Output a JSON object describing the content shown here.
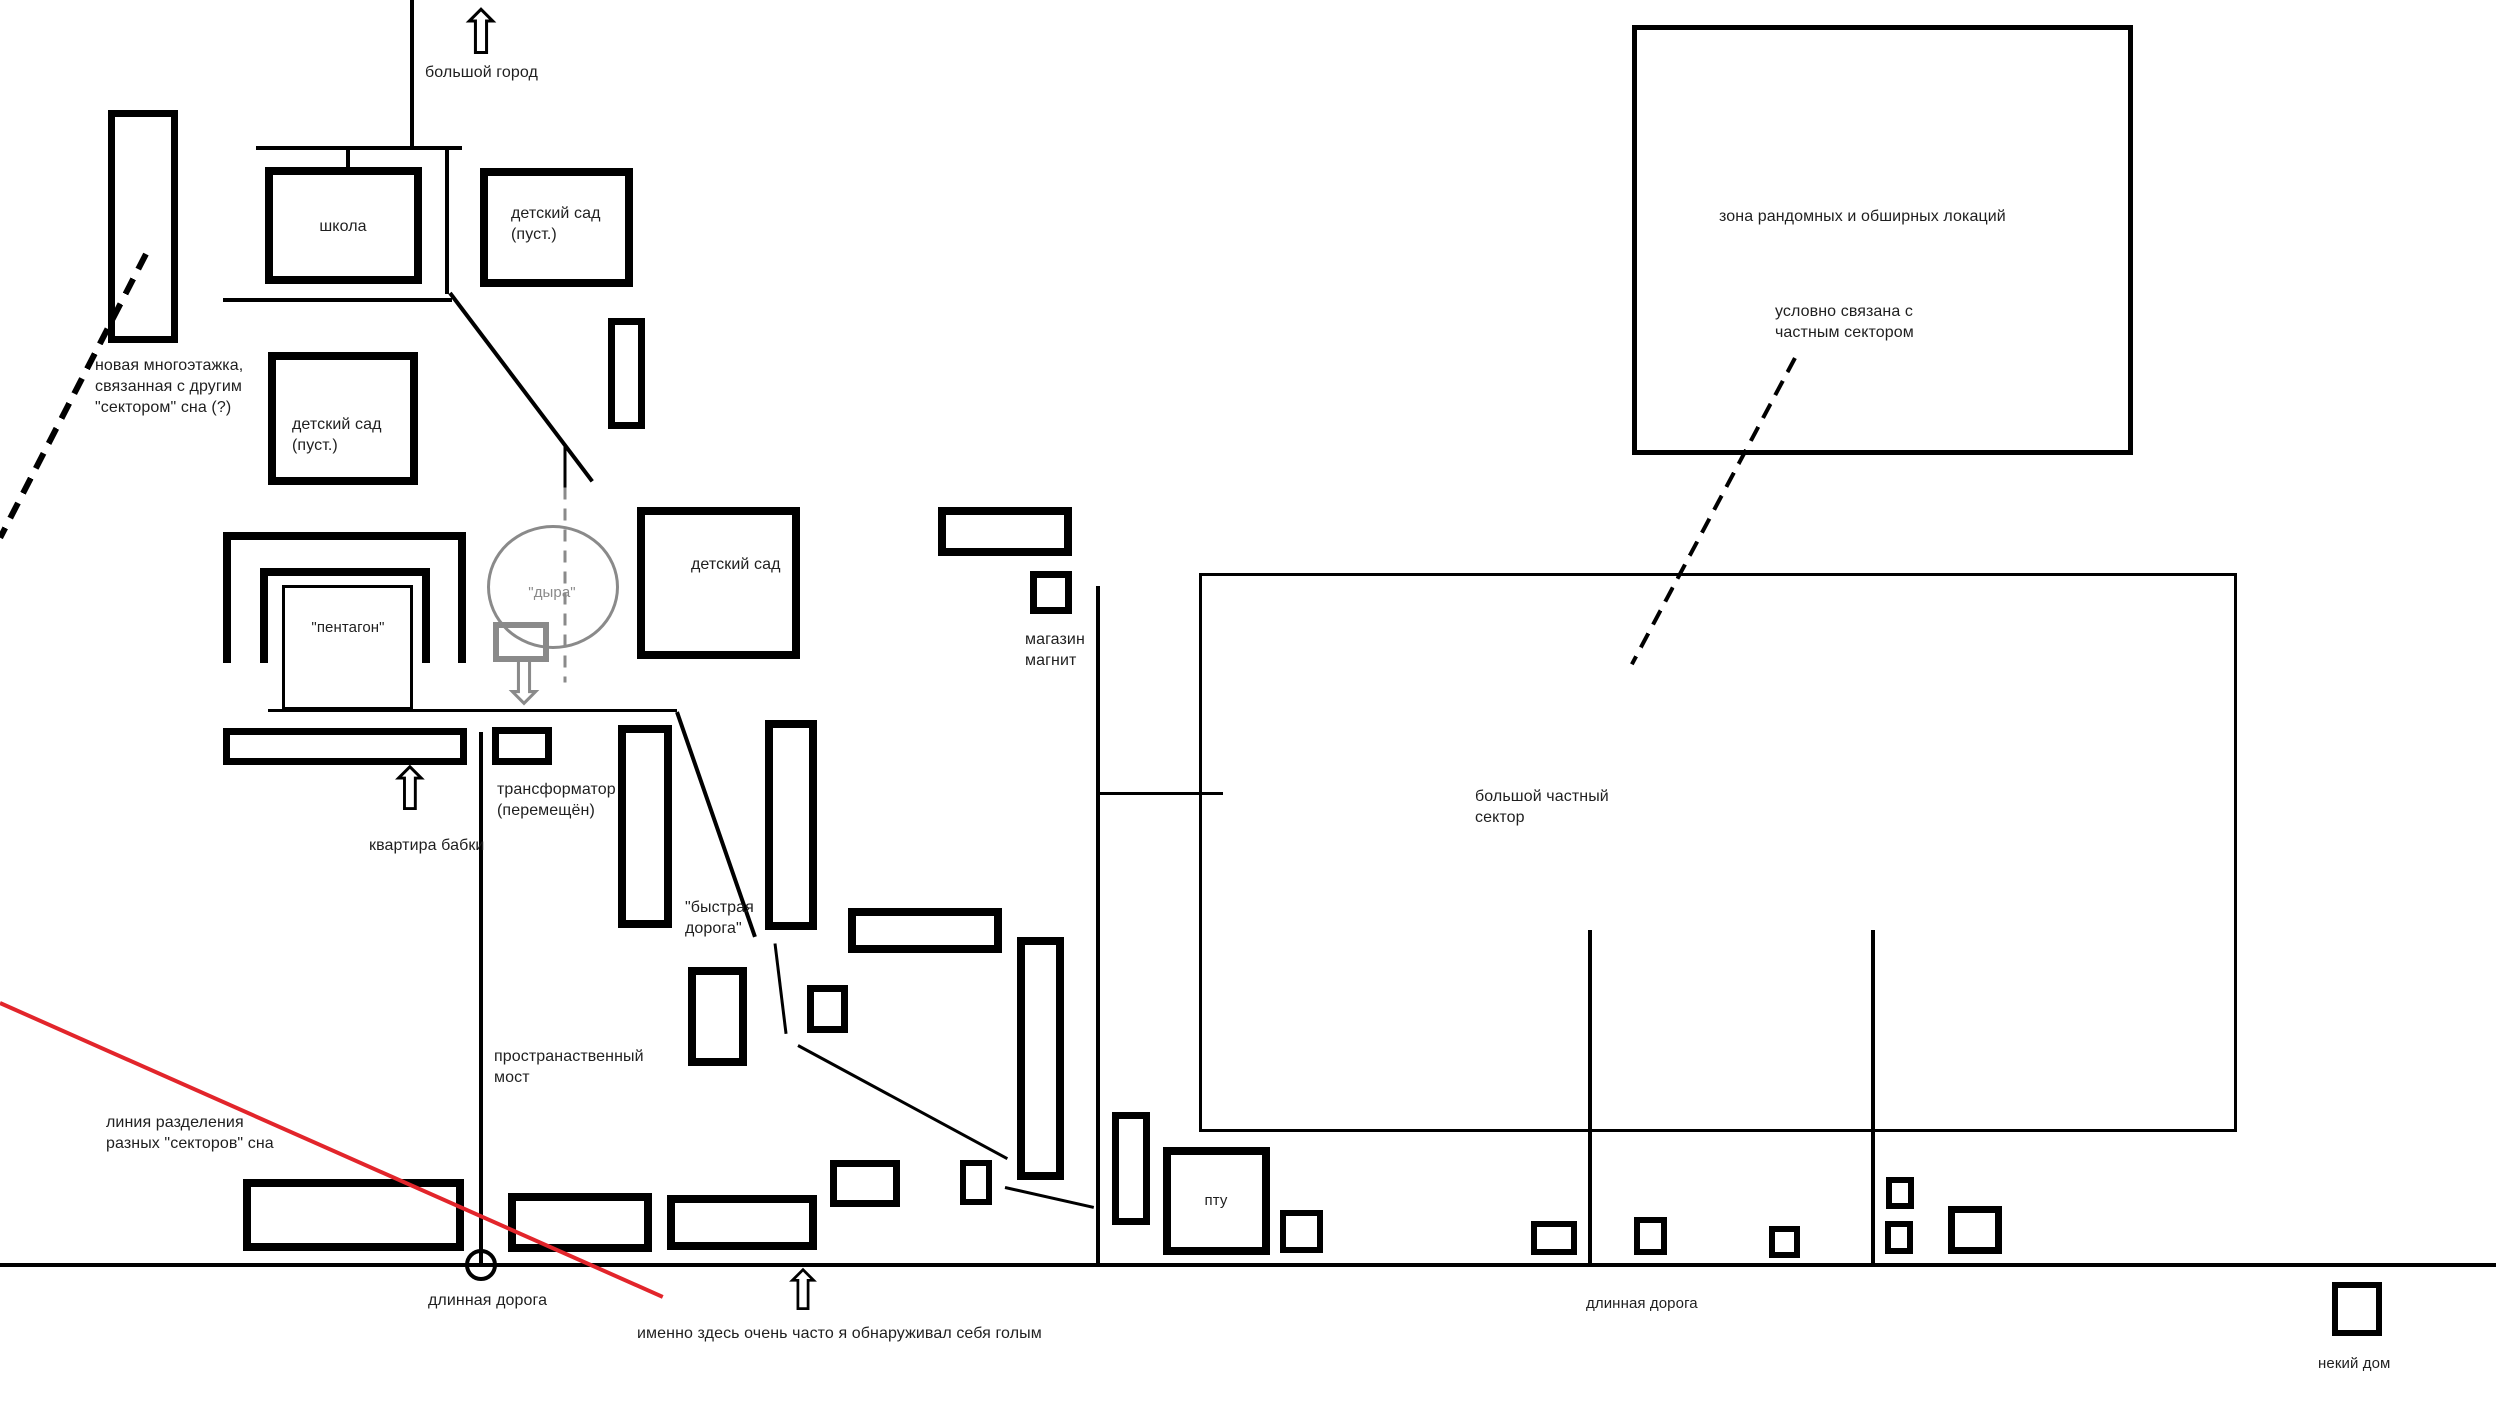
{
  "canvas": {
    "width": 2496,
    "height": 1428,
    "background": "#ffffff"
  },
  "palette": {
    "ink": "#000000",
    "gray": "#8a8a8a",
    "red": "#e2252b",
    "text": "#1f1f1f"
  },
  "labels": [
    {
      "name": "label-big-city",
      "text": "большой город",
      "x": 425,
      "y": 62,
      "size": 16
    },
    {
      "name": "label-new-highrise",
      "text": "новая многоэтажка,\nсвязанная с другим\n\"сектором\" сна (?)",
      "x": 95,
      "y": 355,
      "size": 16
    },
    {
      "name": "label-school",
      "text": "школа",
      "x": 343,
      "y": 216,
      "size": 16,
      "center": true
    },
    {
      "name": "label-kindergarten-1",
      "text": "детский сад\n(пуст.)",
      "x": 511,
      "y": 203,
      "size": 16
    },
    {
      "name": "label-kindergarten-2",
      "text": "детский сад\n(пуст.)",
      "x": 292,
      "y": 414,
      "size": 16
    },
    {
      "name": "label-kindergarten-3",
      "text": "детский сад",
      "x": 691,
      "y": 554,
      "size": 16
    },
    {
      "name": "label-pentagon",
      "text": "\"пентагон\"",
      "x": 348,
      "y": 618,
      "size": 15,
      "center": true
    },
    {
      "name": "label-hole",
      "text": "\"дыра\"",
      "x": 552,
      "y": 583,
      "size": 15,
      "center": true,
      "color": "#8a8a8a"
    },
    {
      "name": "label-magnit-store",
      "text": "магазин\nмагнит",
      "x": 1025,
      "y": 629,
      "size": 16
    },
    {
      "name": "label-random-zone",
      "text": "зона рандомных и обширных локаций",
      "x": 1719,
      "y": 206,
      "size": 16
    },
    {
      "name": "label-linked-note",
      "text": "условно связана с\nчастным сектором",
      "x": 1775,
      "y": 301,
      "size": 16
    },
    {
      "name": "label-private-sector",
      "text": "большой частный\nсектор",
      "x": 1475,
      "y": 786,
      "size": 16
    },
    {
      "name": "label-transformer",
      "text": "трансформатор\n(перемещён)",
      "x": 497,
      "y": 779,
      "size": 16
    },
    {
      "name": "label-grandma-flat",
      "text": "квартира бабки",
      "x": 369,
      "y": 835,
      "size": 16
    },
    {
      "name": "label-fast-road",
      "text": "\"быстрая\nдорога\"",
      "x": 685,
      "y": 897,
      "size": 16
    },
    {
      "name": "label-space-bridge",
      "text": "пространаственный\nмост",
      "x": 494,
      "y": 1046,
      "size": 16
    },
    {
      "name": "label-divide-line",
      "text": "линия разделения\nразных \"секторов\" сна",
      "x": 106,
      "y": 1112,
      "size": 16
    },
    {
      "name": "label-long-road-1",
      "text": "длинная дорога",
      "x": 428,
      "y": 1290,
      "size": 16
    },
    {
      "name": "label-naked-note",
      "text": "именно здесь очень часто я обнаруживал себя голым",
      "x": 637,
      "y": 1323,
      "size": 16
    },
    {
      "name": "label-long-road-2",
      "text": "длинная дорога",
      "x": 1586,
      "y": 1294,
      "size": 15
    },
    {
      "name": "label-some-house",
      "text": "некий дом",
      "x": 2318,
      "y": 1354,
      "size": 15
    },
    {
      "name": "label-ptu",
      "text": "пту",
      "x": 1216,
      "y": 1191,
      "size": 15,
      "center": true
    }
  ],
  "rects": [
    {
      "name": "building-tall-left",
      "x": 108,
      "y": 110,
      "w": 70,
      "h": 233,
      "stroke": 7
    },
    {
      "name": "building-school",
      "x": 265,
      "y": 167,
      "w": 157,
      "h": 117,
      "stroke": 8
    },
    {
      "name": "building-kindergarten-1",
      "x": 480,
      "y": 168,
      "w": 153,
      "h": 119,
      "stroke": 8
    },
    {
      "name": "building-kindergarten-2",
      "x": 268,
      "y": 352,
      "w": 150,
      "h": 133,
      "stroke": 8
    },
    {
      "name": "building-small-vertical-1",
      "x": 608,
      "y": 318,
      "w": 37,
      "h": 111,
      "stroke": 7
    },
    {
      "name": "building-kindergarten-3",
      "x": 637,
      "y": 507,
      "w": 163,
      "h": 152,
      "stroke": 8
    },
    {
      "name": "pentagon-outer-u",
      "x": 223,
      "y": 532,
      "w": 243,
      "h": 131,
      "stroke": 8,
      "open_bottom": true
    },
    {
      "name": "pentagon-inner-u",
      "x": 260,
      "y": 568,
      "w": 170,
      "h": 95,
      "stroke": 8,
      "open_bottom": true
    },
    {
      "name": "pentagon-core",
      "x": 282,
      "y": 585,
      "w": 131,
      "h": 125,
      "stroke": 3
    },
    {
      "name": "building-magnit-wide",
      "x": 938,
      "y": 507,
      "w": 134,
      "h": 49,
      "stroke": 8
    },
    {
      "name": "building-magnit-square",
      "x": 1030,
      "y": 571,
      "w": 42,
      "h": 43,
      "stroke": 7
    },
    {
      "name": "zone-random-locations",
      "x": 1632,
      "y": 25,
      "w": 501,
      "h": 430,
      "stroke": 5
    },
    {
      "name": "zone-private-sector",
      "x": 1199,
      "y": 573,
      "w": 1038,
      "h": 559,
      "stroke": 3
    },
    {
      "name": "building-grandma-bar",
      "x": 223,
      "y": 728,
      "w": 244,
      "h": 37,
      "stroke": 7
    },
    {
      "name": "building-transformer",
      "x": 492,
      "y": 727,
      "w": 60,
      "h": 38,
      "stroke": 7
    },
    {
      "name": "building-tall-mid-1",
      "x": 618,
      "y": 725,
      "w": 54,
      "h": 203,
      "stroke": 8
    },
    {
      "name": "building-tall-mid-2",
      "x": 765,
      "y": 720,
      "w": 52,
      "h": 210,
      "stroke": 8
    },
    {
      "name": "building-mid-bar",
      "x": 848,
      "y": 908,
      "w": 154,
      "h": 45,
      "stroke": 8
    },
    {
      "name": "building-small-square-mid",
      "x": 807,
      "y": 985,
      "w": 41,
      "h": 48,
      "stroke": 7
    },
    {
      "name": "building-vrect-below",
      "x": 688,
      "y": 967,
      "w": 59,
      "h": 99,
      "stroke": 8
    },
    {
      "name": "building-tall-mid-3",
      "x": 1017,
      "y": 937,
      "w": 47,
      "h": 243,
      "stroke": 8
    },
    {
      "name": "building-small-left-ptu",
      "x": 960,
      "y": 1160,
      "w": 32,
      "h": 45,
      "stroke": 6
    },
    {
      "name": "building-vrect-ptu",
      "x": 1112,
      "y": 1112,
      "w": 38,
      "h": 113,
      "stroke": 7
    },
    {
      "name": "building-ptu",
      "x": 1163,
      "y": 1147,
      "w": 107,
      "h": 108,
      "stroke": 8
    },
    {
      "name": "building-square-right-ptu",
      "x": 1280,
      "y": 1210,
      "w": 43,
      "h": 43,
      "stroke": 6
    },
    {
      "name": "building-bottom-row-1",
      "x": 243,
      "y": 1179,
      "w": 221,
      "h": 72,
      "stroke": 8
    },
    {
      "name": "building-bottom-row-2",
      "x": 508,
      "y": 1193,
      "w": 144,
      "h": 59,
      "stroke": 8
    },
    {
      "name": "building-bottom-row-3",
      "x": 667,
      "y": 1195,
      "w": 150,
      "h": 55,
      "stroke": 8
    },
    {
      "name": "building-bottom-row-4",
      "x": 830,
      "y": 1160,
      "w": 70,
      "h": 47,
      "stroke": 7
    },
    {
      "name": "building-sector-sq-1",
      "x": 1531,
      "y": 1221,
      "w": 46,
      "h": 34,
      "stroke": 6
    },
    {
      "name": "building-sector-sq-2",
      "x": 1634,
      "y": 1217,
      "w": 33,
      "h": 38,
      "stroke": 6
    },
    {
      "name": "building-sector-sq-3",
      "x": 1769,
      "y": 1226,
      "w": 31,
      "h": 32,
      "stroke": 6
    },
    {
      "name": "building-sector-sq-4",
      "x": 1886,
      "y": 1177,
      "w": 28,
      "h": 32,
      "stroke": 6
    },
    {
      "name": "building-sector-sq-5",
      "x": 1885,
      "y": 1221,
      "w": 28,
      "h": 33,
      "stroke": 6
    },
    {
      "name": "building-sector-sq-6",
      "x": 1948,
      "y": 1206,
      "w": 54,
      "h": 48,
      "stroke": 7
    },
    {
      "name": "building-some-house",
      "x": 2332,
      "y": 1282,
      "w": 50,
      "h": 54,
      "stroke": 6
    },
    {
      "name": "hole-square",
      "x": 493,
      "y": 622,
      "w": 56,
      "h": 40,
      "stroke": 6,
      "color": "#8a8a8a"
    }
  ],
  "lines": [
    {
      "name": "road-big-city-vertical",
      "x1": 412,
      "y1": 0,
      "x2": 412,
      "y2": 148,
      "w": 4
    },
    {
      "name": "road-school-top",
      "x1": 256,
      "y1": 148,
      "x2": 462,
      "y2": 148,
      "w": 4
    },
    {
      "name": "school-connector",
      "x1": 348,
      "y1": 148,
      "x2": 348,
      "y2": 168,
      "w": 4
    },
    {
      "name": "road-school-right",
      "x1": 447,
      "y1": 150,
      "x2": 447,
      "y2": 294,
      "w": 4
    },
    {
      "name": "road-school-diagonal",
      "x1": 450,
      "y1": 293,
      "x2": 592,
      "y2": 481,
      "w": 4
    },
    {
      "name": "road-school-bottom",
      "x1": 223,
      "y1": 300,
      "x2": 452,
      "y2": 300,
      "w": 4
    },
    {
      "name": "hole-stub",
      "x1": 565,
      "y1": 444,
      "x2": 565,
      "y2": 487,
      "w": 3
    },
    {
      "name": "hole-dashed-line",
      "x1": 565,
      "y1": 487,
      "x2": 565,
      "y2": 682,
      "w": 3,
      "color": "#8a8a8a",
      "dash": 12,
      "gap": 9
    },
    {
      "name": "sector-link-dashed-left",
      "x1": 146,
      "y1": 254,
      "x2": 0,
      "y2": 538,
      "w": 6,
      "dash": 17,
      "gap": 11
    },
    {
      "name": "road-pentagon-bottom",
      "x1": 268,
      "y1": 710,
      "x2": 677,
      "y2": 710,
      "w": 3
    },
    {
      "name": "road-bridge-vertical",
      "x1": 481,
      "y1": 732,
      "x2": 481,
      "y2": 1265,
      "w": 4
    },
    {
      "name": "road-long-horizontal",
      "x1": 0,
      "y1": 1265,
      "x2": 2496,
      "y2": 1265,
      "w": 4
    },
    {
      "name": "sector-divide-red-line",
      "x1": 0,
      "y1": 1003,
      "x2": 663,
      "y2": 1297,
      "w": 4,
      "color": "#e2252b"
    },
    {
      "name": "fast-road-segment-1",
      "x1": 677,
      "y1": 712,
      "x2": 755,
      "y2": 937,
      "w": 4
    },
    {
      "name": "fast-road-segment-2",
      "x1": 775,
      "y1": 943,
      "x2": 786,
      "y2": 1033,
      "w": 3
    },
    {
      "name": "fast-road-segment-3",
      "x1": 798,
      "y1": 1045,
      "x2": 1007,
      "y2": 1158,
      "w": 3
    },
    {
      "name": "fast-road-segment-4",
      "x1": 1005,
      "y1": 1187,
      "x2": 1094,
      "y2": 1207,
      "w": 3
    },
    {
      "name": "road-magnit-vertical",
      "x1": 1098,
      "y1": 586,
      "x2": 1098,
      "y2": 1265,
      "w": 4
    },
    {
      "name": "road-sector-entry",
      "x1": 1098,
      "y1": 793,
      "x2": 1223,
      "y2": 793,
      "w": 3
    },
    {
      "name": "sector-inner-vertical-1",
      "x1": 1590,
      "y1": 930,
      "x2": 1590,
      "y2": 1265,
      "w": 4
    },
    {
      "name": "sector-inner-vertical-2",
      "x1": 1873,
      "y1": 930,
      "x2": 1873,
      "y2": 1265,
      "w": 4
    },
    {
      "name": "zone-link-dashed",
      "x1": 1795,
      "y1": 358,
      "x2": 1632,
      "y2": 664,
      "w": 4,
      "dash": 16,
      "gap": 10
    }
  ],
  "ellipses": [
    {
      "name": "hole-circle",
      "cx": 553,
      "cy": 587,
      "rx": 66,
      "ry": 62,
      "stroke": 3,
      "color": "#8a8a8a"
    },
    {
      "name": "crossroads-circle",
      "cx": 481,
      "cy": 1265,
      "rx": 16,
      "ry": 16,
      "stroke": 4,
      "color": "#000000"
    }
  ],
  "arrows": [
    {
      "name": "big-city-arrow-icon",
      "glyph": "⇧",
      "x": 481,
      "y": 2,
      "size": 62,
      "color": "#000000"
    },
    {
      "name": "grandma-arrow-icon",
      "glyph": "⇧",
      "x": 410,
      "y": 760,
      "size": 60,
      "color": "#000000"
    },
    {
      "name": "naked-spot-arrow-icon",
      "glyph": "⇧",
      "x": 803,
      "y": 1264,
      "size": 56,
      "color": "#000000"
    },
    {
      "name": "hole-arrow-icon",
      "glyph": "⇩",
      "x": 524,
      "y": 652,
      "size": 62,
      "color": "#8a8a8a"
    }
  ]
}
